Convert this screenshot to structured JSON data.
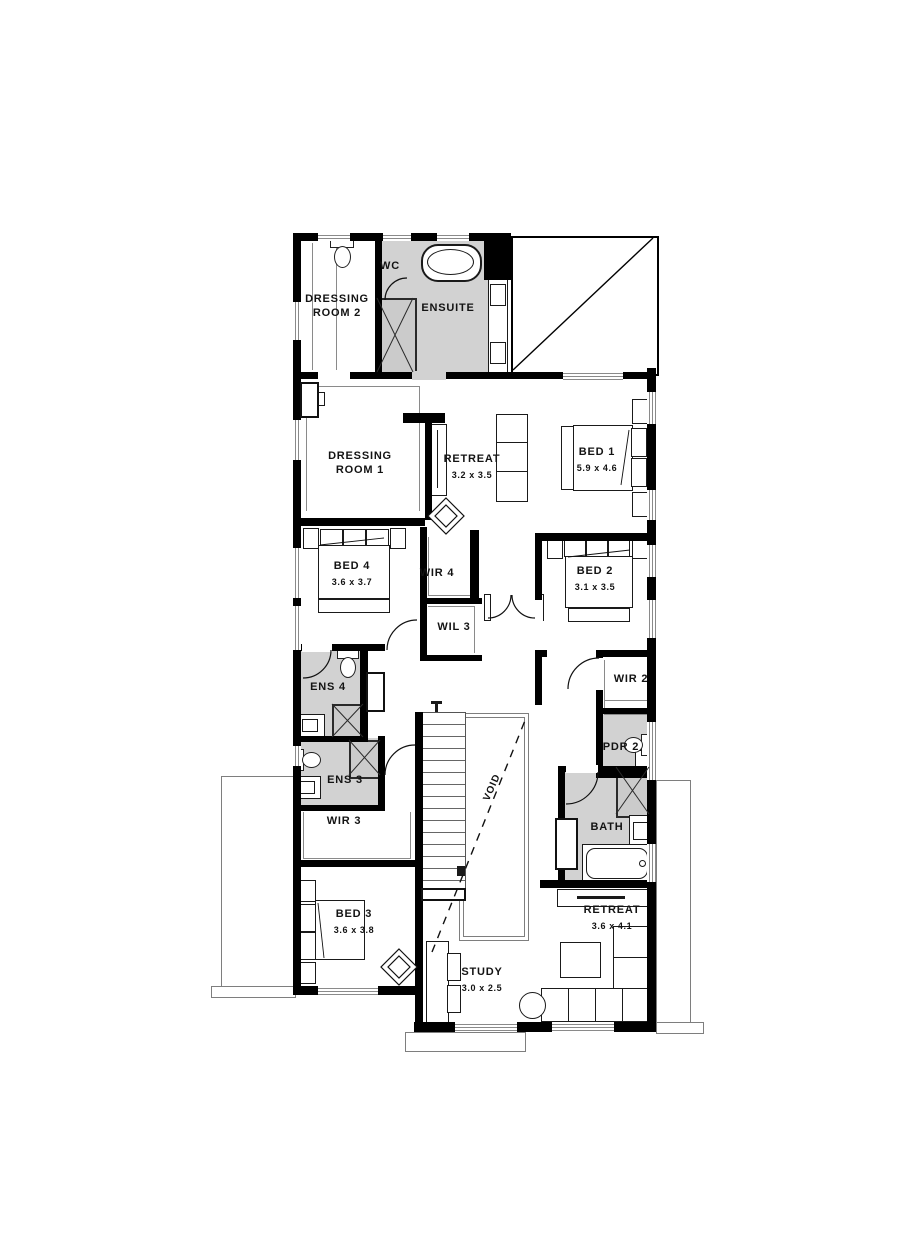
{
  "plan_title": "First floor plan",
  "colors": {
    "wall": "#000000",
    "wet_area": "#d2d2d2",
    "outline": "#7e7e7e",
    "background": "#ffffff"
  },
  "rooms": {
    "dressing_room_2": {
      "label": "DRESSING ROOM 2"
    },
    "wc": {
      "label": "WC"
    },
    "ensuite": {
      "label": "ENSUITE"
    },
    "dressing_room_1": {
      "label": "DRESSING ROOM 1"
    },
    "retreat_upper": {
      "label": "RETREAT",
      "dims": "3.2 x 3.5"
    },
    "bed_1": {
      "label": "BED 1",
      "dims": "5.9 x 4.6"
    },
    "bed_4": {
      "label": "BED 4",
      "dims": "3.6 x 3.7"
    },
    "wir_4": {
      "label": "WIR 4"
    },
    "wil_3": {
      "label": "WIL 3"
    },
    "bed_2": {
      "label": "BED 2",
      "dims": "3.1 x 3.5"
    },
    "ens_4": {
      "label": "ENS 4"
    },
    "wir_2": {
      "label": "WIR 2"
    },
    "pdr_2": {
      "label": "PDR 2"
    },
    "ens_3": {
      "label": "ENS 3"
    },
    "wir_3": {
      "label": "WIR 3"
    },
    "bed_3": {
      "label": "BED 3",
      "dims": "3.6 x 3.8"
    },
    "bath": {
      "label": "BATH"
    },
    "retreat_lower": {
      "label": "RETREAT",
      "dims": "3.6 x 4.1"
    },
    "study": {
      "label": "STUDY",
      "dims": "3.0 x 2.5"
    },
    "void": {
      "label": "VOID"
    }
  }
}
